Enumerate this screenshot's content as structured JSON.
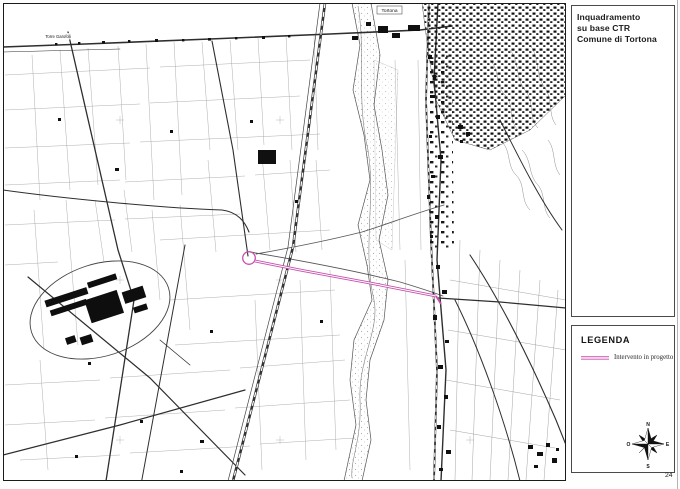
{
  "document": {
    "page_number": "24"
  },
  "title_box": {
    "line1": "Inquadramento",
    "line2": "su base CTR",
    "line3": "Comune di Tortona"
  },
  "legend": {
    "title": "LEGENDA",
    "item": {
      "label": "Intervento in progetto",
      "line_color": "#c84fae"
    }
  },
  "compass": {
    "north": "N",
    "south": "S",
    "east": "E",
    "west": "O"
  },
  "map": {
    "labels": {
      "city": "Tortona",
      "locality": "Torre Garofoli"
    },
    "project_line_color": "#c84fae",
    "ink_color": "#1a1a1a"
  }
}
